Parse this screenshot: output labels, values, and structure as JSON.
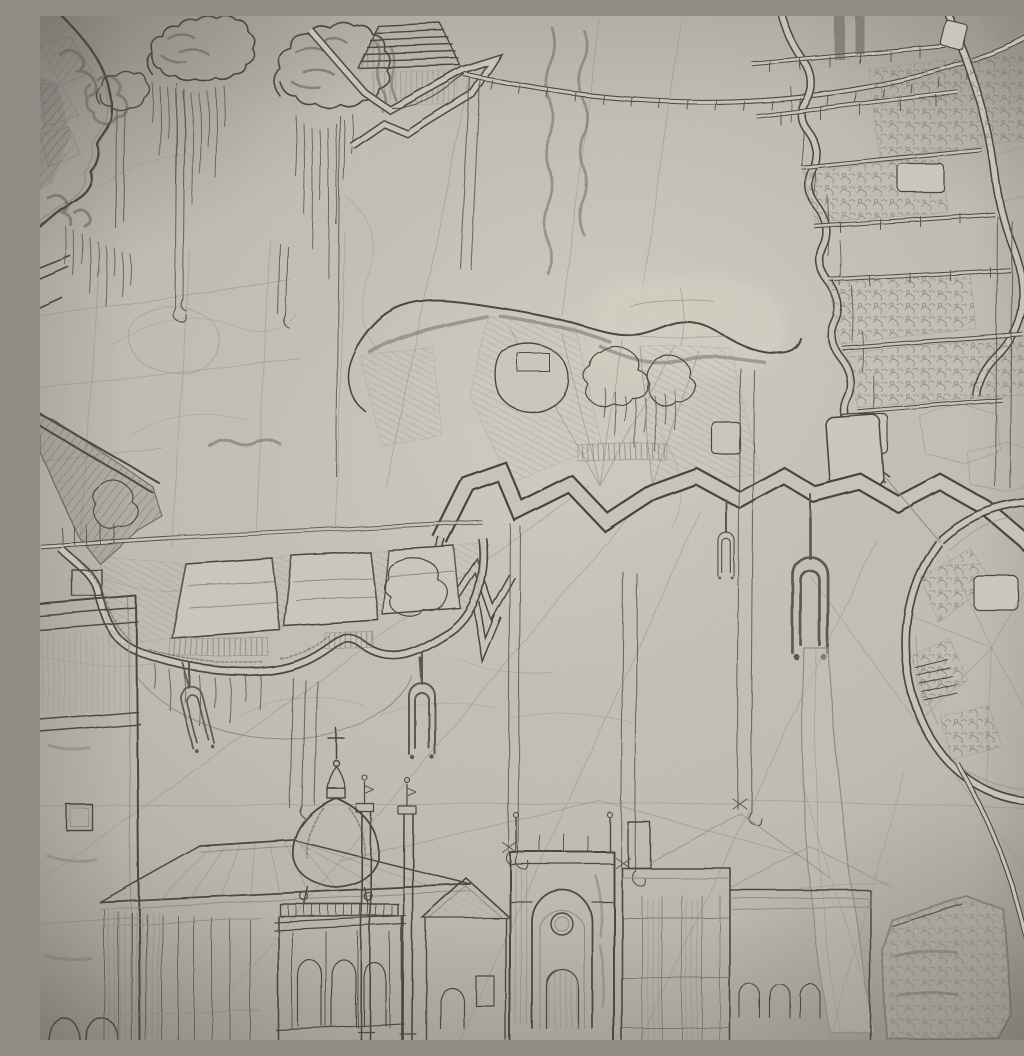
{
  "artwork": {
    "medium": "graphite pencil architectural fantasy drawing photographed on textured grey paper",
    "regions": {
      "photo": "photograph of a detailed pencil drawing: fortified floating island plans suspended on cables above a classical city skyline",
      "top_left_island": "fortified plan island with domed rampart wall, upper left corner",
      "top_clouds": "scribbled foliage clouds with hanging drip lines, top centre",
      "stairs": "stepped ziggurat ramp, top centre",
      "zigzag_wall": "zig-zag lightning rampart band, top centre",
      "top_road": "curving elevated road ribbon across the top",
      "top_right_island": "terraced island plan with curved rampart walls and deck bands, upper right",
      "center_island": "central floating island with scalloped cliff edge, pale lake, hatched slopes and zig-zag rampart road",
      "left_island": "left island with keystone shaped courts, scalloped wall and hanging pendants",
      "octagon_island": "octagonal bastion island at the right edge",
      "cables": "long vertical suspension cables with hooked ends",
      "pendants": "tuning-fork shaped pendants hanging below the islands",
      "blade": "long tapered blade hanging down into the city",
      "city": "classical city elevation along the bottom",
      "left_building": "tall corniced stone building, bottom left edge",
      "greenhouse": "glass-roofed conservatory pavilion, lower left",
      "dome": "onion-domed spire with cross and balustraded facade",
      "columns": "twin slender free-standing columns with finials",
      "gable_house": "small gabled house between columns and gate",
      "gate_tower": "great arched gate tower with oculus, bottom centre",
      "pavilion": "flat-roofed pavilion and pitched roofs, bottom centre-right",
      "right_wing": "arcaded low wing, bottom right",
      "shield_panel": "tilted hatched shield panel and wall strip, bottom right corner"
    }
  },
  "palette": {
    "paper": "#c4c0b8",
    "paper_light": "#d8d4c7",
    "paper_shadow": "#a5a199",
    "ink_dark": "#403c36",
    "ink": "#57534c",
    "ink_faint": "#8f8b81"
  }
}
